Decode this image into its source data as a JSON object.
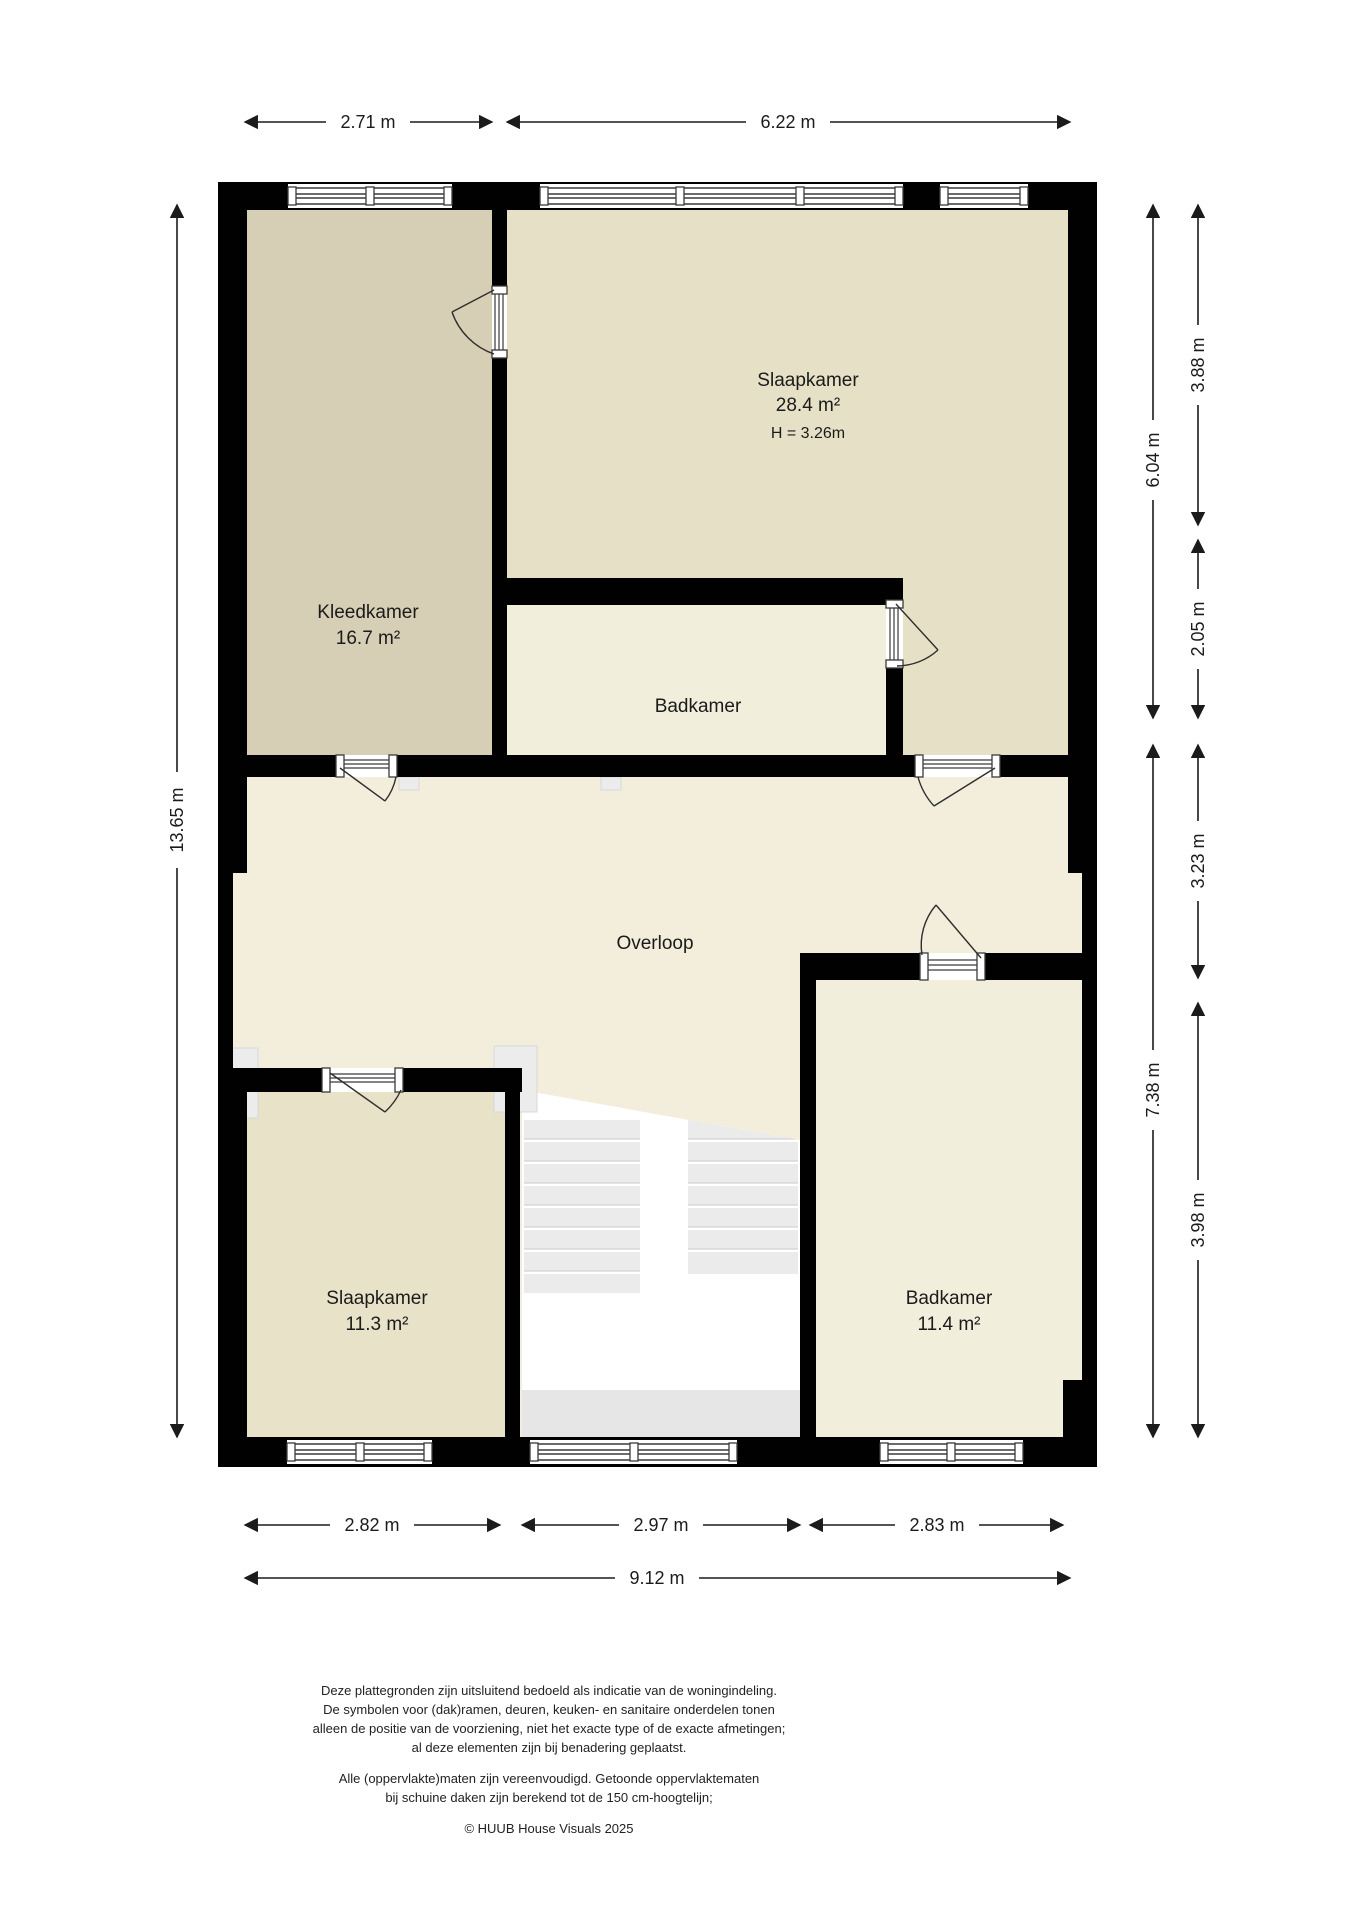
{
  "rooms": {
    "kleedkamer": {
      "name": "Kleedkamer",
      "area": "16.7 m²"
    },
    "slaapkamer_top": {
      "name": "Slaapkamer",
      "area": "28.4 m²",
      "height": "H = 3.26m"
    },
    "badkamer_top": {
      "name": "Badkamer"
    },
    "overloop": {
      "name": "Overloop"
    },
    "slaapkamer_bottom": {
      "name": "Slaapkamer",
      "area": "11.3 m²"
    },
    "badkamer_bottom": {
      "name": "Badkamer",
      "area": "11.4 m²"
    }
  },
  "dims": {
    "top_left": "2.71 m",
    "top_right": "6.22 m",
    "left_total": "13.65 m",
    "right_inner_top": "6.04 m",
    "right_inner_bottom": "7.38 m",
    "right_outer_1": "3.88 m",
    "right_outer_2": "2.05 m",
    "right_outer_3": "3.23 m",
    "right_outer_4": "3.98 m",
    "bottom_1": "2.82 m",
    "bottom_2": "2.97 m",
    "bottom_3": "2.83 m",
    "bottom_total": "9.12 m"
  },
  "footer": {
    "line1": "Deze plattegronden zijn uitsluitend bedoeld als indicatie van de woningindeling.",
    "line2": "De symbolen voor (dak)ramen, deuren, keuken- en sanitaire onderdelen tonen",
    "line3": "alleen de positie van de voorziening, niet het exacte type of de exacte afmetingen;",
    "line4": "al deze elementen zijn bij benadering geplaatst.",
    "line5": "Alle (oppervlakte)maten zijn vereenvoudigd. Getoonde oppervlaktematen",
    "line6": "bij schuine daken zijn berekend tot de 150 cm-hoogtelijn;",
    "copyright": "© HUUB House Visuals 2025"
  },
  "colors": {
    "wall": "#010101",
    "kleedkamer_fill": "#d6cfb5",
    "slaapkamer_top_fill": "#e6e0c6",
    "badkamer_top_fill": "#f1eedc",
    "overloop_fill": "#f2eedb",
    "slaapkamer_bottom_fill": "#e8e2c9",
    "badkamer_bottom_fill": "#f2eedc",
    "stair_tread": "#ebebeb",
    "dimension_text": "#1b1b1b"
  }
}
